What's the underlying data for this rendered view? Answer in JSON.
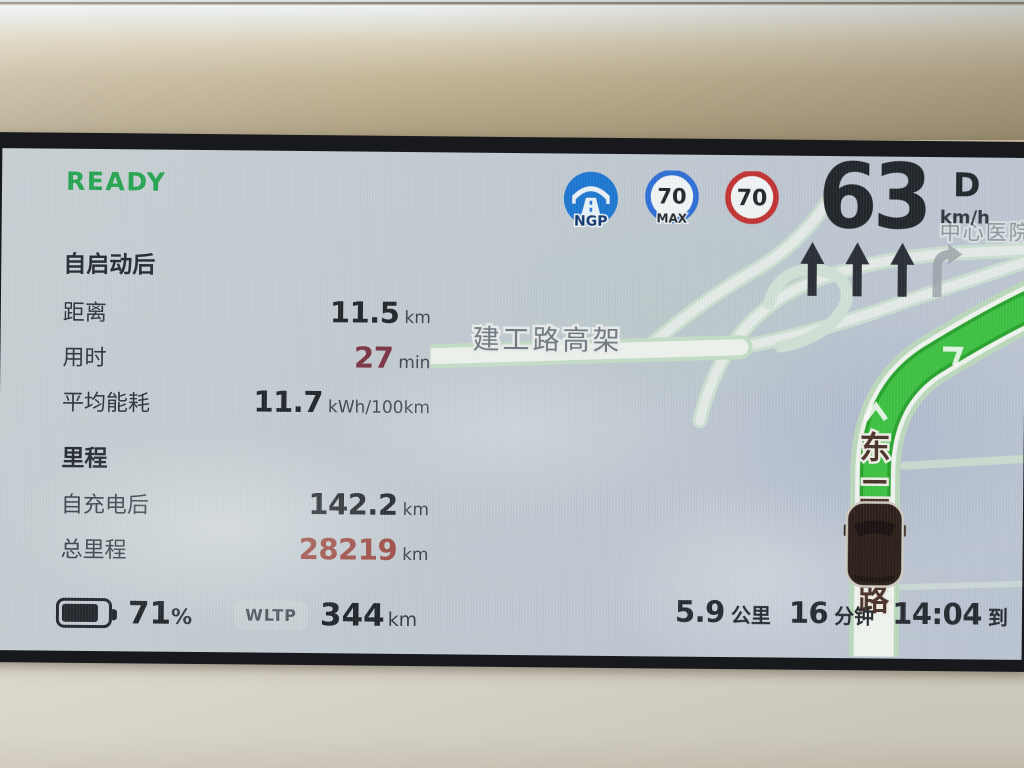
{
  "status": {
    "ready_label": "READY"
  },
  "trip_since_start": {
    "title": "自启动后",
    "rows": [
      {
        "label": "距离",
        "value": "11.5",
        "unit": "km"
      },
      {
        "label": "用时",
        "value": "27",
        "unit": "min"
      },
      {
        "label": "平均能耗",
        "value": "11.7",
        "unit": "kWh/100km"
      }
    ]
  },
  "mileage": {
    "title": "里程",
    "rows": [
      {
        "label": "自充电后",
        "value": "142.2",
        "unit": "km"
      },
      {
        "label": "总里程",
        "value": "28219",
        "unit": "km"
      }
    ]
  },
  "speed": {
    "value": "63",
    "unit": "km/h",
    "gear": "D"
  },
  "driver_assist": {
    "ngp_label": "NGP",
    "max_speed_value": "70",
    "max_speed_label": "MAX",
    "speed_limit_value": "70"
  },
  "battery": {
    "percent_value": "71",
    "percent_sign": "%",
    "wltp_label": "WLTP",
    "range_value": "344",
    "range_unit": "km"
  },
  "route_summary": {
    "distance_value": "5.9",
    "distance_unit": "公里",
    "time_value": "16",
    "time_unit": "分钟",
    "arrival_time": "14:04",
    "arrival_suffix": "到"
  },
  "map": {
    "elevated_road_label": "建工路高架",
    "current_road_chars": [
      "东",
      "二",
      "路"
    ],
    "poi_label": "中心医院"
  },
  "colors": {
    "accent_green": "#27a653",
    "route_green": "#3fc244",
    "duration_red": "#7d3646",
    "odometer_red": "#9c4a42",
    "ngp_blue": "#1f78d1",
    "limit_red": "#c23434"
  }
}
